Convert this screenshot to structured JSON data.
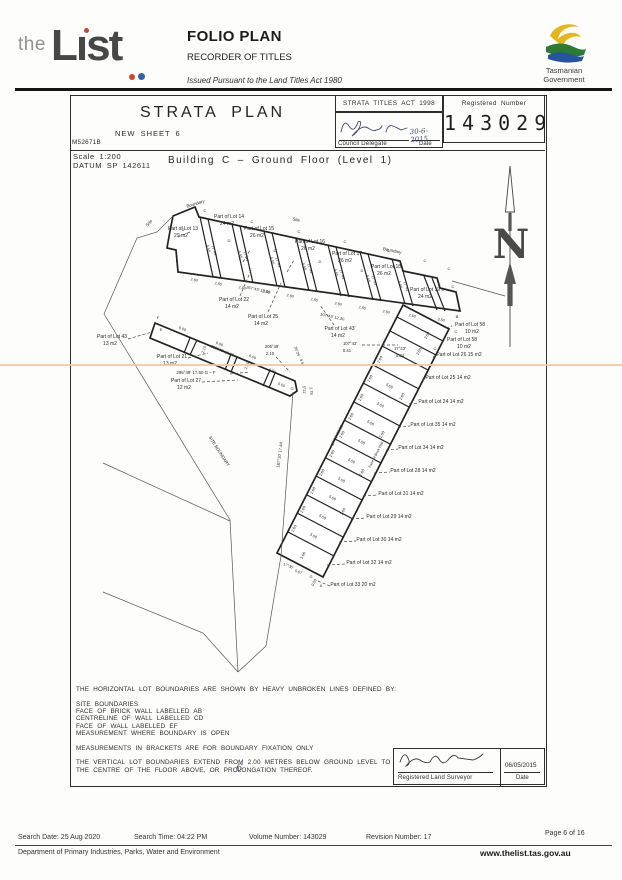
{
  "header": {
    "logo_the": "the",
    "logo_list": "Lıst",
    "folio_title": "FOLIO PLAN",
    "recorder": "RECORDER OF TITLES",
    "issued": "Issued Pursuant to the Land Titles Act 1980",
    "gov_line1": "Tasmanian",
    "gov_line2": "Government"
  },
  "title_block": {
    "title": "STRATA PLAN",
    "sheet": "NEW SHEET 6",
    "ref": "M52671B",
    "act": "STRATA TITLES ACT 1998",
    "delegate_label": "Council Delegate",
    "delegate_date_label": "Date",
    "delegate_date": "30-6-2015",
    "registered_label": "Registered Number",
    "registered_number": "143029"
  },
  "plan_header": {
    "scale": "Scale 1:200",
    "datum": "DATUM SP 142611",
    "building": "Building C – Ground Floor (Level 1)"
  },
  "plan": {
    "north_letter": "N",
    "texts": [
      [
        "Part of Lot 13",
        183,
        230,
        5
      ],
      [
        "29 m2",
        181,
        237,
        5
      ],
      [
        "Part of Lot 14",
        229,
        218,
        5
      ],
      [
        "24 m2",
        227,
        225,
        5
      ],
      [
        "Part of Lot 15",
        259,
        230,
        5
      ],
      [
        "26 m2",
        257,
        237,
        5
      ],
      [
        "Part of Lot 16",
        310,
        243,
        5
      ],
      [
        "26 m2",
        308,
        250,
        5
      ],
      [
        "Part of Lot 17",
        347,
        255,
        5
      ],
      [
        "26 m2",
        345,
        262,
        5
      ],
      [
        "Part of Lot 18",
        386,
        268,
        5
      ],
      [
        "26 m2",
        384,
        275,
        5
      ],
      [
        "Part of Lot 19 c",
        427,
        291,
        5
      ],
      [
        "24 m2",
        425,
        298,
        5
      ],
      [
        "Part of Lot 22",
        234,
        301,
        5
      ],
      [
        "14 m2",
        232,
        308,
        5
      ],
      [
        "Part of Lot 25",
        263,
        318,
        5
      ],
      [
        "14 m2",
        261,
        325,
        5
      ],
      [
        "Part of Lot 43'",
        340,
        330,
        5
      ],
      [
        "14 m2",
        338,
        337,
        5
      ],
      [
        "107°43'",
        350,
        345,
        4.2
      ],
      [
        "0.41",
        347,
        352,
        4.2
      ],
      [
        "17°43'",
        400,
        350,
        4.2
      ],
      [
        "0.84",
        400,
        357,
        4.2
      ],
      [
        "Part of Lot 43",
        112,
        338,
        5
      ],
      [
        "13 m2",
        110,
        345,
        5
      ],
      [
        "Part of Lot 21",
        172,
        358,
        5
      ],
      [
        "13 m2",
        170,
        365,
        5
      ],
      [
        "295°49'  17.50   G – F",
        196,
        374,
        4.4
      ],
      [
        "Part of Lot 27",
        186,
        382,
        5
      ],
      [
        "12 m2",
        184,
        389,
        5
      ],
      [
        "205°49'",
        272,
        348,
        4.2
      ],
      [
        "2.10",
        270,
        355,
        4.2
      ],
      [
        "Part of Lot 58",
        470,
        326,
        5
      ],
      [
        "10 m2",
        472,
        333,
        5
      ],
      [
        "Part of Lot 58",
        462,
        341,
        5
      ],
      [
        "10 m2",
        464,
        348,
        5
      ],
      [
        "Part of Lot 26 15 m2",
        459,
        356,
        5
      ],
      [
        "Part of Lot 25 14 m2",
        448,
        379,
        5
      ],
      [
        "Part of Lot 24 14 m2",
        441,
        403,
        5
      ],
      [
        "Part of Lot 35 14 m2",
        433,
        426,
        5
      ],
      [
        "Part of Lot 34 14 m2",
        421,
        449,
        5
      ],
      [
        "Part of Lot 28 14 m2",
        413,
        472,
        5
      ],
      [
        "Part of Lot 31 14 m2",
        401,
        495,
        5
      ],
      [
        "Part of Lot 29 14 m2",
        389,
        518,
        5
      ],
      [
        "Part of Lot 30 14 m2",
        379,
        541,
        5
      ],
      [
        "Part of Lot 32 14 m2",
        369,
        564,
        5
      ],
      [
        "Part of Lot 33 20 m2",
        353,
        586,
        5
      ],
      [
        "Boundary",
        196,
        205,
        4.4,
        -17
      ],
      [
        "Site",
        150,
        224,
        4.4,
        -48
      ],
      [
        "Site",
        296,
        221,
        4.4,
        12
      ],
      [
        "Boundary",
        392,
        252,
        4.4,
        12
      ],
      [
        "SITE BOUNDARY",
        218,
        452,
        4.3,
        57
      ],
      [
        "187°10'  17.44",
        281,
        455,
        4.2,
        -83
      ],
      [
        "267°43'  13.00",
        258,
        291,
        4,
        12
      ],
      [
        "107°43'  12.30",
        332,
        318,
        4,
        12
      ],
      [
        "2.60",
        194,
        281,
        3.8,
        12
      ],
      [
        "2.60",
        218,
        285,
        3.8,
        12
      ],
      [
        "2.60",
        242,
        289,
        3.8,
        12
      ],
      [
        "2.60",
        266,
        293,
        3.8,
        12
      ],
      [
        "2.60",
        290,
        297,
        3.8,
        12
      ],
      [
        "2.60",
        314,
        301,
        3.8,
        12
      ],
      [
        "2.60",
        338,
        305,
        3.8,
        12
      ],
      [
        "2.60",
        362,
        309,
        3.8,
        12
      ],
      [
        "2.60",
        386,
        313,
        3.8,
        12
      ],
      [
        "2.60",
        412,
        317,
        3.8,
        12
      ],
      [
        "3.50",
        441,
        321,
        3.8,
        12
      ],
      [
        "5.55",
        207,
        249,
        3.8,
        73
      ],
      [
        "17°43'",
        213,
        251,
        3.8,
        73
      ],
      [
        "5.55",
        239,
        255,
        3.8,
        73
      ],
      [
        "17°43'",
        245,
        257,
        3.8,
        73
      ],
      [
        "5.55",
        271,
        261,
        3.8,
        73
      ],
      [
        "17°43'",
        277,
        263,
        3.8,
        73
      ],
      [
        "5.55",
        303,
        267,
        3.8,
        73
      ],
      [
        "17°43'",
        309,
        269,
        3.8,
        73
      ],
      [
        "5.55",
        335,
        273,
        3.8,
        73
      ],
      [
        "17°43'",
        341,
        275,
        3.8,
        73
      ],
      [
        "5.55",
        367,
        279,
        3.8,
        73
      ],
      [
        "17°43'",
        373,
        281,
        3.8,
        73
      ],
      [
        "5.55",
        399,
        285,
        3.8,
        73
      ],
      [
        "17°43'",
        405,
        287,
        3.8,
        73
      ],
      [
        "6.00",
        182,
        330,
        3.8,
        22
      ],
      [
        "6.00",
        219,
        345,
        3.8,
        22
      ],
      [
        "6.00",
        252,
        358,
        3.8,
        22
      ],
      [
        "295°49'  17.50",
        222,
        352,
        4,
        22
      ],
      [
        "2.10",
        205,
        350,
        3.8,
        -70
      ],
      [
        "2.10",
        248,
        366,
        3.8,
        -70
      ],
      [
        "5.50",
        272,
        372,
        3.8,
        22
      ],
      [
        "5.50",
        281,
        386,
        3.8,
        22
      ],
      [
        "35°25'",
        296,
        352,
        3.8,
        70
      ],
      [
        "9.58",
        301,
        363,
        3.8,
        70
      ],
      [
        "5°11'",
        303,
        390,
        3.8,
        85
      ],
      [
        "2.78",
        310,
        391,
        3.8,
        85
      ],
      [
        "2.60",
        381,
        360,
        3.8,
        -63
      ],
      [
        "2.60",
        371,
        379,
        3.8,
        -63
      ],
      [
        "2.60",
        362,
        398,
        3.8,
        -63
      ],
      [
        "2.60",
        352,
        417,
        3.8,
        -63
      ],
      [
        "2.60",
        343,
        435,
        3.8,
        -63
      ],
      [
        "2.60",
        333,
        454,
        3.8,
        -63
      ],
      [
        "2.60",
        323,
        473,
        3.8,
        -63
      ],
      [
        "2.60",
        314,
        491,
        3.8,
        -63
      ],
      [
        "2.60",
        304,
        510,
        3.8,
        -63
      ],
      [
        "2.60",
        295,
        529,
        3.8,
        -63
      ],
      [
        "5.50",
        389,
        387,
        3.8,
        28
      ],
      [
        "5.50",
        380,
        406,
        3.8,
        28
      ],
      [
        "5.50",
        370,
        424,
        3.8,
        28
      ],
      [
        "5.50",
        361,
        443,
        3.8,
        28
      ],
      [
        "5.50",
        351,
        462,
        3.8,
        28
      ],
      [
        "5.50",
        341,
        481,
        3.8,
        28
      ],
      [
        "5.50",
        332,
        499,
        3.8,
        28
      ],
      [
        "5.50",
        322,
        518,
        3.8,
        28
      ],
      [
        "5.50",
        313,
        537,
        3.8,
        28
      ],
      [
        "2.60",
        403,
        397,
        3.8,
        -63
      ],
      [
        "2.60",
        383,
        435,
        3.8,
        -63
      ],
      [
        "2.60",
        363,
        473,
        3.8,
        -63
      ],
      [
        "2.60",
        344,
        512,
        3.8,
        -63
      ],
      [
        "2.50",
        428,
        336,
        3.8,
        -63
      ],
      [
        "2.50",
        420,
        352,
        3.8,
        -63
      ],
      [
        "17°36'  38.50",
        338,
        436,
        4,
        -63
      ],
      [
        "Face of Brick Wall",
        377,
        455,
        3.6,
        -63
      ],
      [
        "17°36'",
        288,
        567,
        3.8,
        22
      ],
      [
        "5.67",
        298,
        573,
        3.8,
        22
      ],
      [
        "0.50",
        315,
        583,
        3.8,
        -63
      ],
      [
        "3.66",
        304,
        556,
        3.8,
        -63
      ],
      [
        "C",
        205,
        212,
        4
      ],
      [
        "C",
        252,
        223,
        4
      ],
      [
        "C",
        299,
        233,
        4
      ],
      [
        "C",
        345,
        243,
        4
      ],
      [
        "C",
        388,
        252,
        4
      ],
      [
        "C",
        425,
        262,
        4
      ],
      [
        "C",
        449,
        270,
        4
      ],
      [
        "C",
        453,
        288,
        4
      ],
      [
        "C",
        456,
        333,
        4
      ],
      [
        "C",
        435,
        350,
        4
      ],
      [
        "D",
        183,
        231,
        4
      ],
      [
        "D",
        229,
        242,
        4
      ],
      [
        "D",
        275,
        252,
        4
      ],
      [
        "D",
        320,
        263,
        4
      ],
      [
        "D",
        362,
        272,
        4
      ],
      [
        "F",
        177,
        262,
        4
      ],
      [
        "F",
        158,
        319,
        4
      ],
      [
        "E",
        161,
        331,
        4
      ],
      [
        "G",
        292,
        390,
        4
      ],
      [
        "G",
        311,
        578,
        4
      ],
      [
        "B",
        457,
        318,
        4
      ],
      [
        "A",
        321,
        587,
        4
      ]
    ]
  },
  "notes": {
    "lines": [
      "THE HORIZONTAL LOT BOUNDARIES ARE SHOWN BY HEAVY UNBROKEN LINES DEFINED BY:",
      "",
      "SITE BOUNDARIES",
      "FACE OF BRICK WALL LABELLED AB",
      "CENTRELINE OF WALL LABELLED CD",
      "FACE OF WALL LABELLED EF",
      "MEASUREMENT WHERE BOUNDARY IS OPEN",
      "",
      "MEASUREMENTS IN BRACKETS ARE FOR BOUNDARY FIXATION ONLY",
      "",
      "THE VERTICAL LOT BOUNDARIES EXTEND FROM 2.00 METRES BELOW GROUND LEVEL TO",
      "THE CENTRE OF THE FLOOR ABOVE, OR PROLONGATION THEREOF."
    ],
    "annotation": "6"
  },
  "surveyor": {
    "label": "Registered Land Surveyor",
    "date": "06/05/2015",
    "date_label": "Date"
  },
  "footer": {
    "search_date": "Search Date: 25 Aug 2020",
    "search_time": "Search Time: 04:22 PM",
    "volume": "Volume Number: 143029",
    "revision": "Revision Number: 17",
    "page": "Page 6 of 16",
    "department": "Department of Primary Industries, Parks, Water and Environment",
    "website": "www.thelist.tas.gov.au"
  }
}
